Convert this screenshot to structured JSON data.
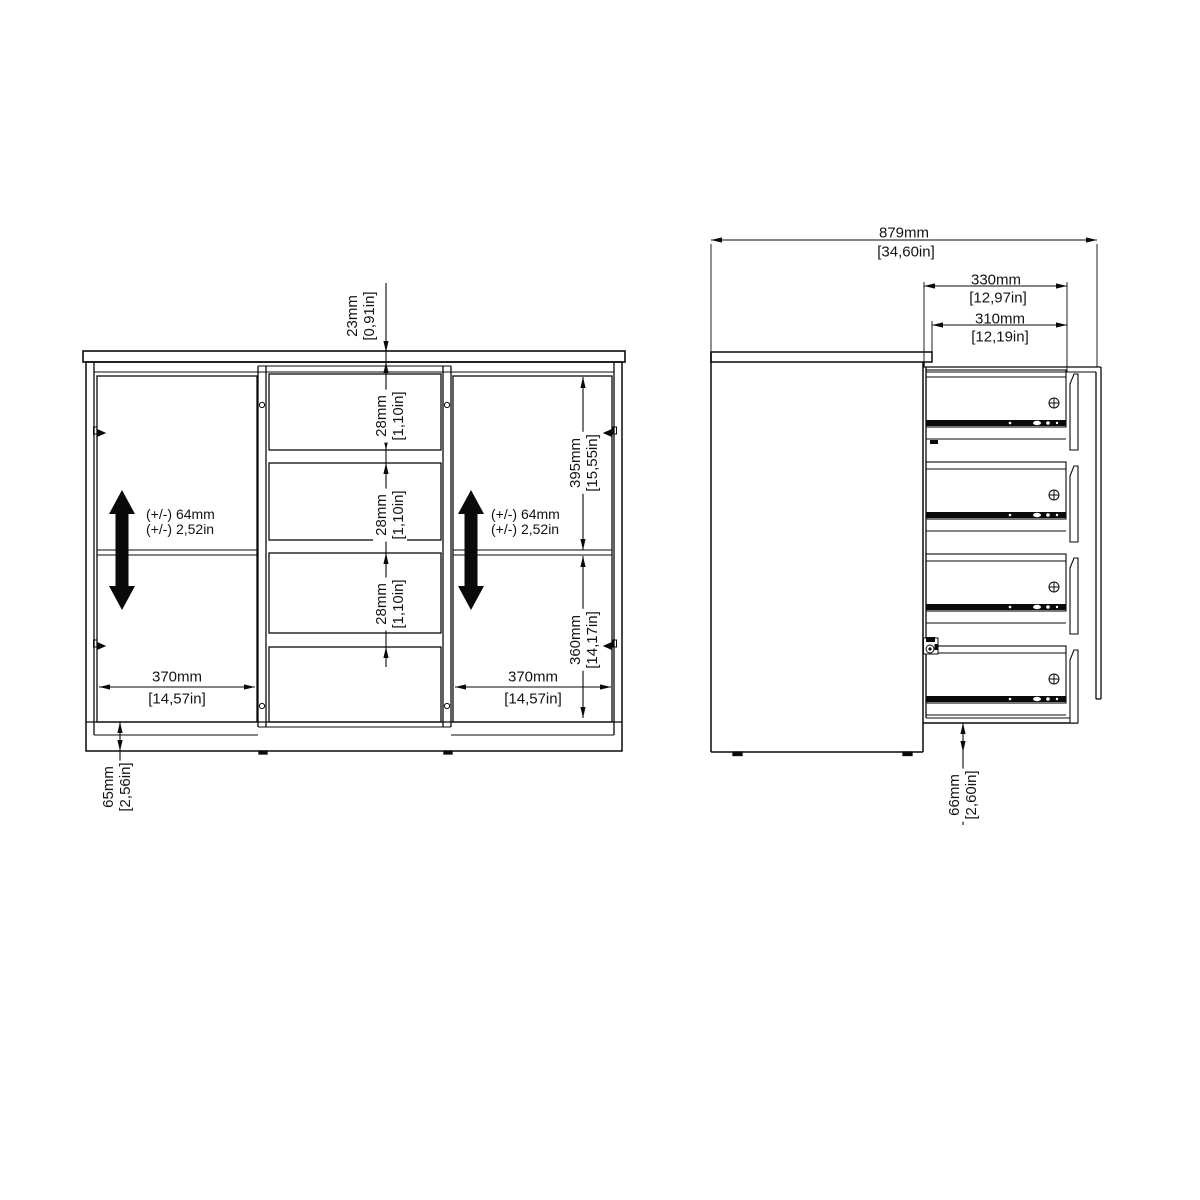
{
  "front_view": {
    "top_thickness": {
      "mm": "23mm",
      "inch": "[0,91in]"
    },
    "drawer_gap": {
      "mm": "28mm",
      "inch": "[1,10in]"
    },
    "shelf_adjust_left": {
      "line1": "(+/-) 64mm",
      "line2": "(+/-) 2,52in"
    },
    "shelf_adjust_right": {
      "line1": "(+/-) 64mm",
      "line2": "(+/-) 2,52in"
    },
    "door_width_left": {
      "mm": "370mm",
      "inch": "[14,57in]"
    },
    "door_width_right": {
      "mm": "370mm",
      "inch": "[14,57in]"
    },
    "upper_height": {
      "mm": "395mm",
      "inch": "[15,55in]"
    },
    "lower_height": {
      "mm": "360mm",
      "inch": "[14,17in]"
    },
    "plinth_height": {
      "mm": "65mm",
      "inch": "[2,56in]"
    }
  },
  "side_view": {
    "total_width": {
      "mm": "879mm",
      "inch": "[34,60in]"
    },
    "drawer_depth_outer": {
      "mm": "330mm",
      "inch": "[12,97in]"
    },
    "drawer_depth_inner": {
      "mm": "310mm",
      "inch": "[12,19in]"
    },
    "base_height": {
      "mm": "66mm",
      "inch": "[2,60in]"
    }
  },
  "colors": {
    "line": "#0a0a0a",
    "background": "#ffffff"
  }
}
